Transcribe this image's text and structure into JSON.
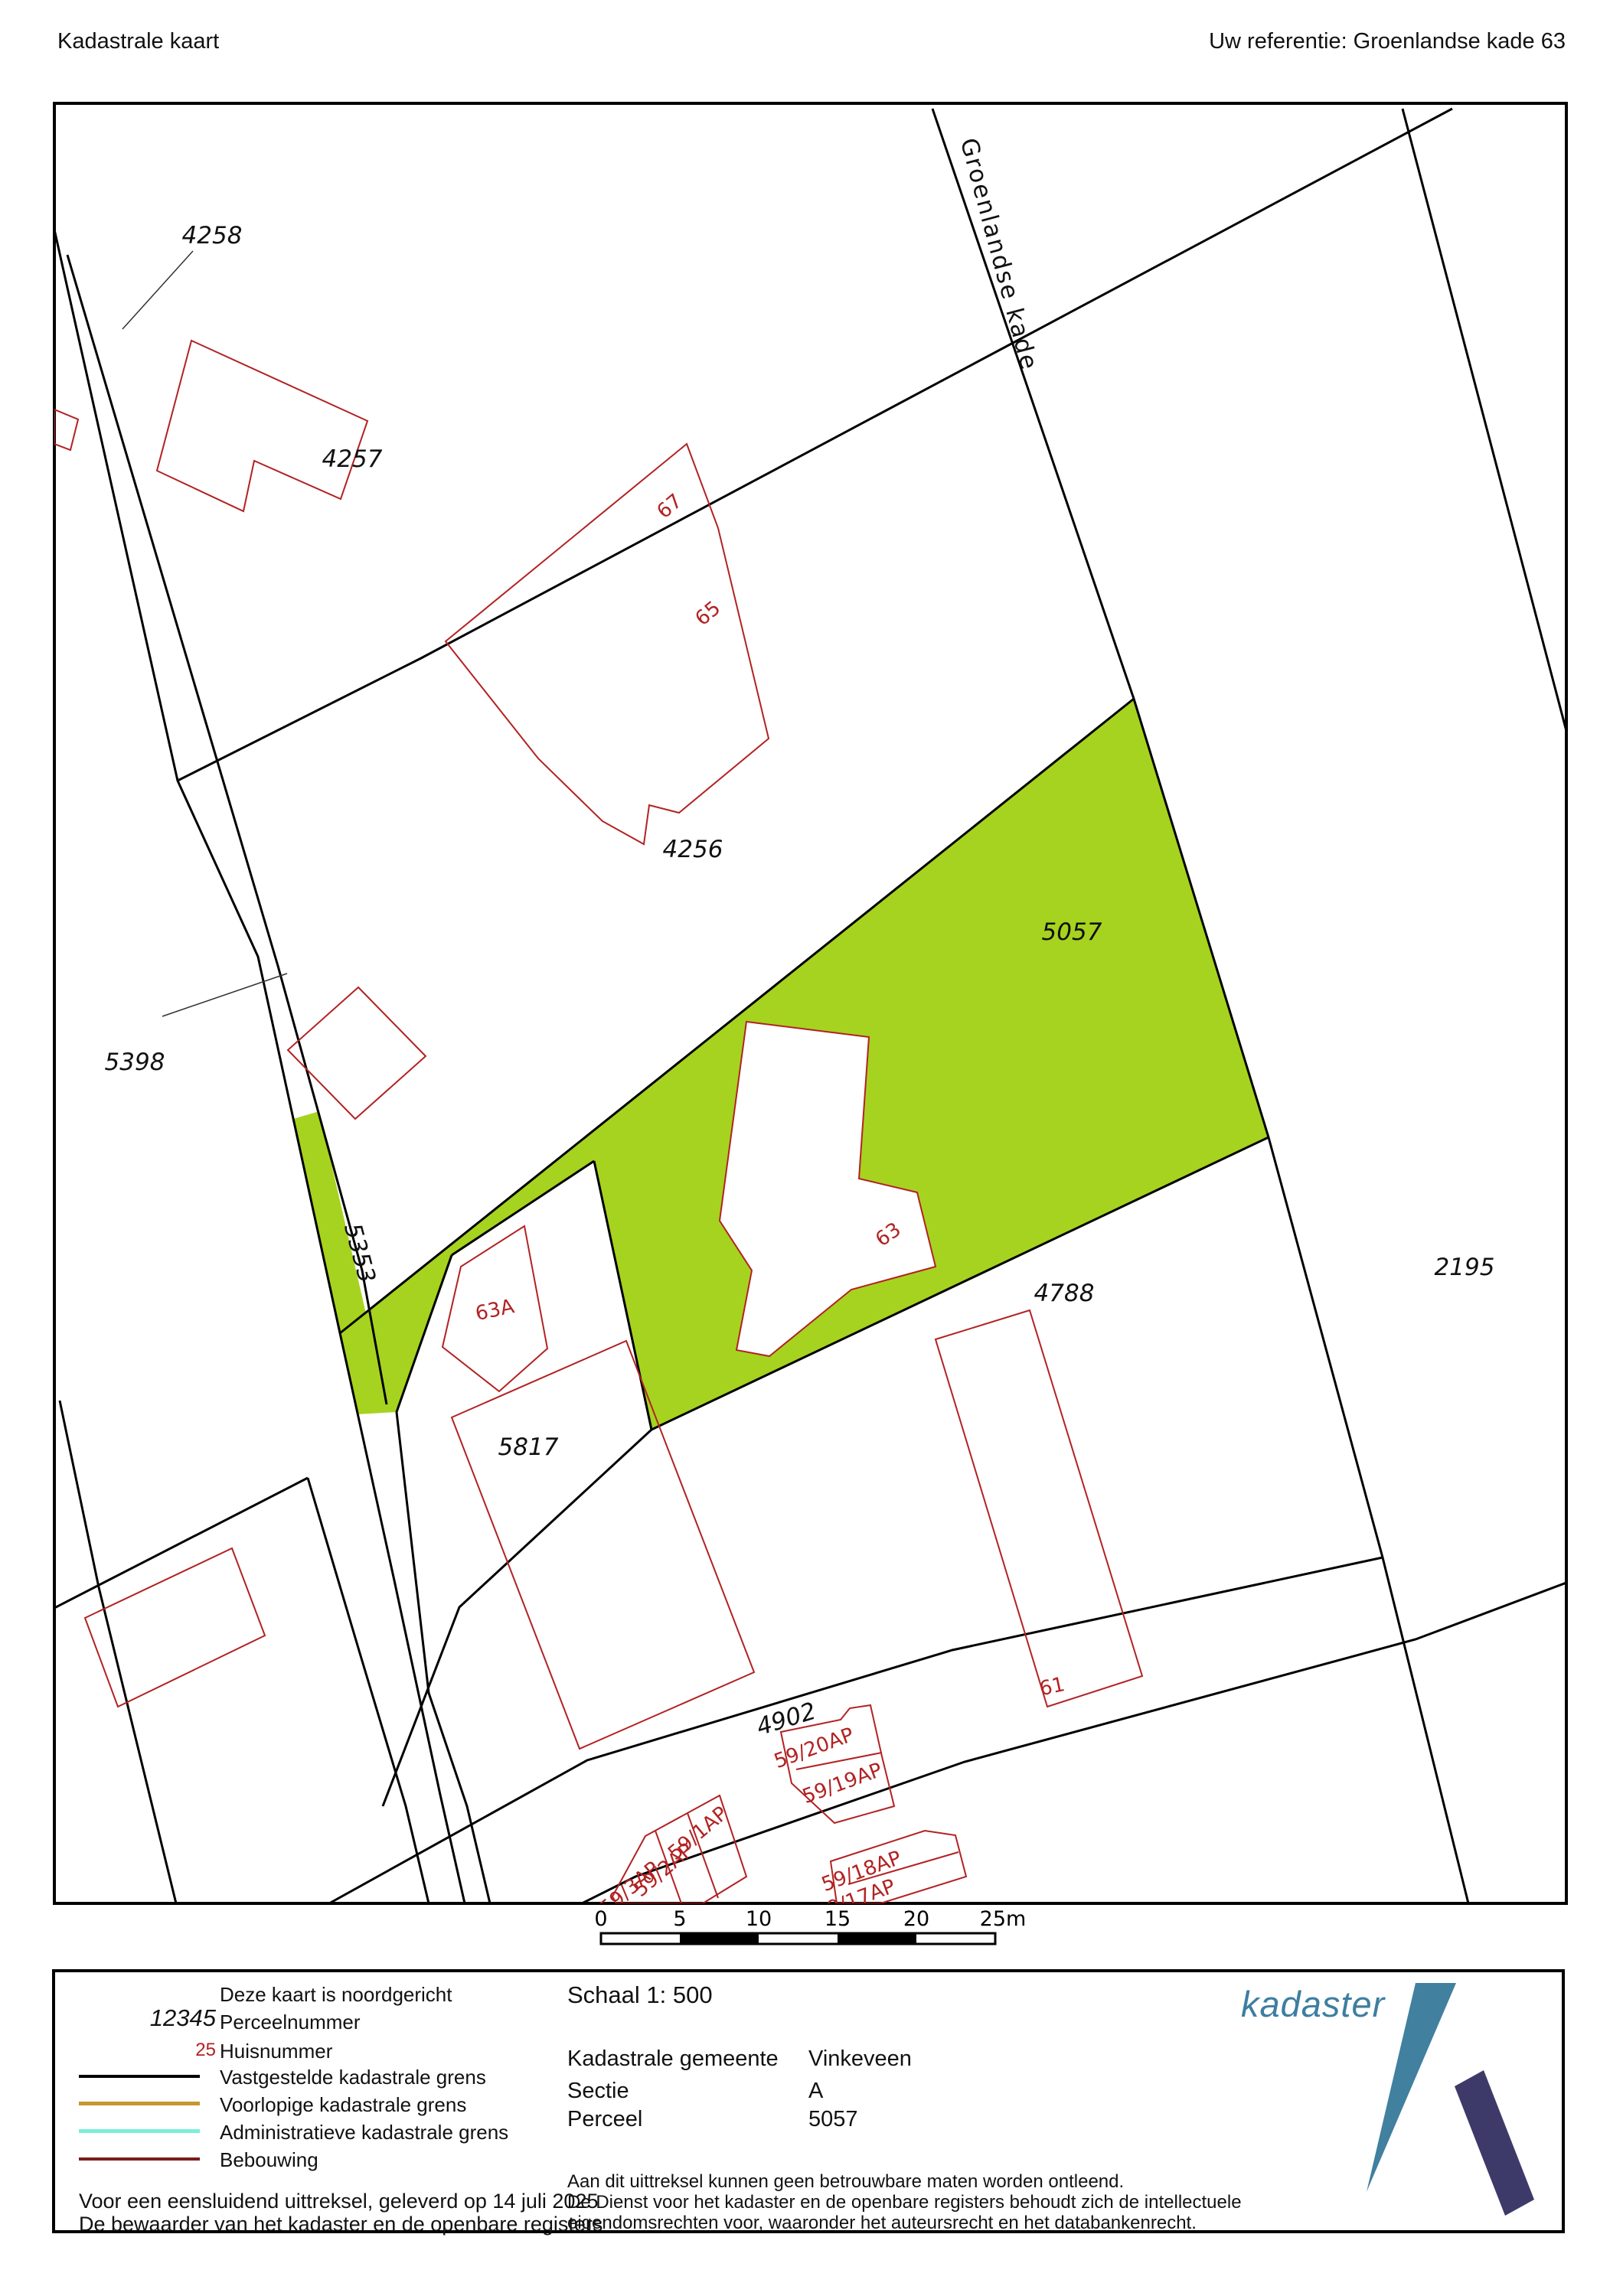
{
  "header": {
    "title": "Kadastrale kaart",
    "reference": "Uw referentie: Groenlandse kade 63"
  },
  "map": {
    "highlight_color": "#A6D31F",
    "street_label": "Groenlandse kade",
    "parcel_labels": [
      "4258",
      "4257",
      "4256",
      "5398",
      "5353",
      "5817",
      "5057",
      "4788",
      "2195",
      "4902"
    ],
    "house_labels": [
      "67",
      "65",
      "63A",
      "63",
      "61",
      "59/20AP",
      "59/19AP",
      "59/1AP",
      "59/2AP",
      "59/3AP",
      "59/18AP",
      "59/17AP"
    ],
    "boundary_color": "#000000",
    "building_color": "#B22222",
    "scale_bar": {
      "tick_labels": [
        "0",
        "5",
        "10",
        "15",
        "20",
        "25m"
      ]
    }
  },
  "legend": {
    "north_note": "Deze kaart is noordgericht",
    "parcel_sample": "12345",
    "parcel_label": "Perceelnummer",
    "house_sample": "25",
    "house_label": "Huisnummer",
    "lines": [
      {
        "label": "Vastgestelde kadastrale grens",
        "color": "#000000"
      },
      {
        "label": "Voorlopige kadastrale grens",
        "color": "#C8962E"
      },
      {
        "label": "Administratieve kadastrale grens",
        "color": "#7CEEDC"
      },
      {
        "label": "Bebouwing",
        "color": "#7A1B1B"
      }
    ],
    "certification": [
      "Voor een eensluidend uittreksel, geleverd op 14 juli 2025",
      "De bewaarder van het kadaster en de openbare registers"
    ]
  },
  "info": {
    "scale": "Schaal 1: 500",
    "rows": [
      {
        "label": "Kadastrale gemeente",
        "value": "Vinkeveen"
      },
      {
        "label": "Sectie",
        "value": "A"
      },
      {
        "label": "Perceel",
        "value": "5057"
      }
    ],
    "disclaimer": [
      "Aan dit uittreksel kunnen geen betrouwbare maten worden ontleend.",
      "De Dienst voor het kadaster en de openbare registers behoudt zich de intellectuele",
      "eigendomsrechten voor, waaronder het auteursrecht en het databankenrecht."
    ]
  },
  "logo": {
    "text": "kadaster",
    "text_color": "#3E7EA1",
    "blade_color": "#41809E",
    "leg_color": "#3D3A69"
  }
}
